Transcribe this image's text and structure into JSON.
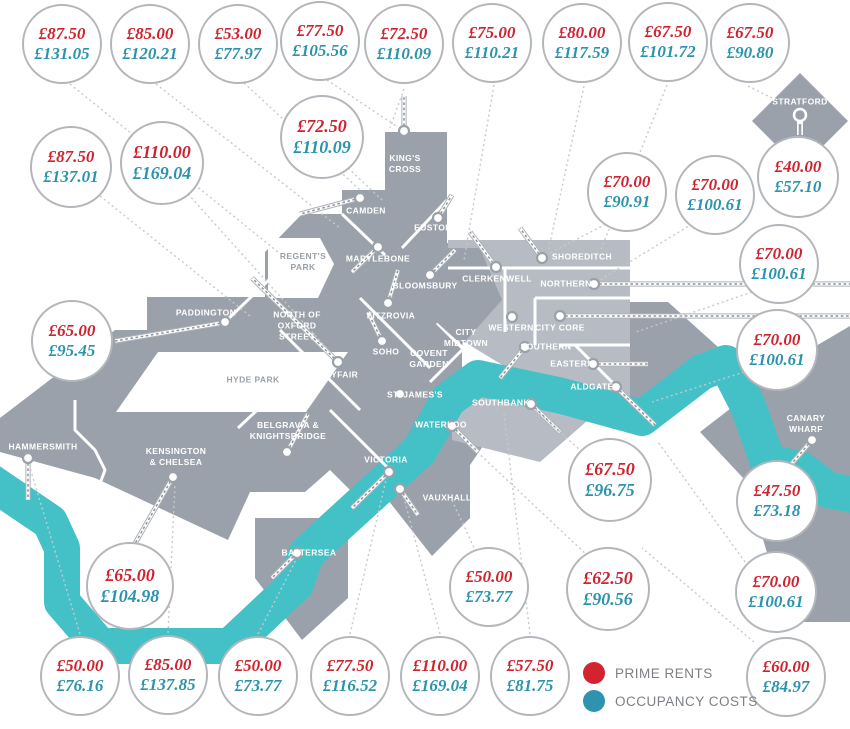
{
  "colors": {
    "rent": "#cf2430",
    "cost": "#2b93ad",
    "river": "#44c1c7",
    "land": "#9ba1aa",
    "land_light": "#b7bcc4"
  },
  "legend": {
    "items": [
      {
        "label": "PRIME RENTS",
        "color": "#d2232f"
      },
      {
        "label": "OCCUPANCY COSTS",
        "color": "#2e93ae"
      }
    ]
  },
  "bubbles": [
    {
      "rent": "£87.50",
      "cost": "£131.05",
      "x": 62,
      "y": 44,
      "r": 40
    },
    {
      "rent": "£85.00",
      "cost": "£120.21",
      "x": 150,
      "y": 44,
      "r": 40
    },
    {
      "rent": "£53.00",
      "cost": "£77.97",
      "x": 238,
      "y": 44,
      "r": 40
    },
    {
      "rent": "£77.50",
      "cost": "£105.56",
      "x": 320,
      "y": 41,
      "r": 40
    },
    {
      "rent": "£72.50",
      "cost": "£110.09",
      "x": 404,
      "y": 44,
      "r": 40
    },
    {
      "rent": "£75.00",
      "cost": "£110.21",
      "x": 492,
      "y": 43,
      "r": 40
    },
    {
      "rent": "£80.00",
      "cost": "£117.59",
      "x": 582,
      "y": 43,
      "r": 40
    },
    {
      "rent": "£67.50",
      "cost": "£101.72",
      "x": 668,
      "y": 42,
      "r": 40
    },
    {
      "rent": "£67.50",
      "cost": "£90.80",
      "x": 750,
      "y": 43,
      "r": 40
    },
    {
      "rent": "£87.50",
      "cost": "£137.01",
      "x": 71,
      "y": 167,
      "r": 41
    },
    {
      "rent": "£110.00",
      "cost": "£169.04",
      "x": 162,
      "y": 163,
      "r": 42
    },
    {
      "rent": "£72.50",
      "cost": "£110.09",
      "x": 322,
      "y": 137,
      "r": 42
    },
    {
      "rent": "£40.00",
      "cost": "£57.10",
      "x": 798,
      "y": 177,
      "r": 41
    },
    {
      "rent": "£70.00",
      "cost": "£90.91",
      "x": 627,
      "y": 192,
      "r": 40
    },
    {
      "rent": "£70.00",
      "cost": "£100.61",
      "x": 715,
      "y": 195,
      "r": 40
    },
    {
      "rent": "£70.00",
      "cost": "£100.61",
      "x": 779,
      "y": 264,
      "r": 40
    },
    {
      "rent": "£65.00",
      "cost": "£95.45",
      "x": 72,
      "y": 341,
      "r": 41
    },
    {
      "rent": "£70.00",
      "cost": "£100.61",
      "x": 777,
      "y": 350,
      "r": 41
    },
    {
      "rent": "£47.50",
      "cost": "£73.18",
      "x": 777,
      "y": 501,
      "r": 41
    },
    {
      "rent": "£67.50",
      "cost": "£96.75",
      "x": 610,
      "y": 480,
      "r": 42
    },
    {
      "rent": "£62.50",
      "cost": "£90.56",
      "x": 608,
      "y": 589,
      "r": 42
    },
    {
      "rent": "£50.00",
      "cost": "£73.77",
      "x": 489,
      "y": 587,
      "r": 40
    },
    {
      "rent": "£65.00",
      "cost": "£104.98",
      "x": 130,
      "y": 586,
      "r": 44
    },
    {
      "rent": "£70.00",
      "cost": "£100.61",
      "x": 776,
      "y": 592,
      "r": 41
    },
    {
      "rent": "£50.00",
      "cost": "£76.16",
      "x": 80,
      "y": 676,
      "r": 40
    },
    {
      "rent": "£85.00",
      "cost": "£137.85",
      "x": 168,
      "y": 675,
      "r": 40
    },
    {
      "rent": "£50.00",
      "cost": "£73.77",
      "x": 258,
      "y": 676,
      "r": 40
    },
    {
      "rent": "£77.50",
      "cost": "£116.52",
      "x": 350,
      "y": 676,
      "r": 40
    },
    {
      "rent": "£110.00",
      "cost": "£169.04",
      "x": 440,
      "y": 676,
      "r": 40
    },
    {
      "rent": "£57.50",
      "cost": "£81.75",
      "x": 530,
      "y": 676,
      "r": 40
    },
    {
      "rent": "£60.00",
      "cost": "£84.97",
      "x": 786,
      "y": 677,
      "r": 40
    }
  ],
  "areas": [
    {
      "label": "STRATFORD",
      "x": 800,
      "y": 102,
      "tone": "on-land"
    },
    {
      "label": "KING'S\nCROSS",
      "x": 405,
      "y": 164,
      "tone": "on-land"
    },
    {
      "label": "CAMDEN",
      "x": 366,
      "y": 211,
      "tone": "on-land"
    },
    {
      "label": "EUSTON",
      "x": 433,
      "y": 228,
      "tone": "on-land"
    },
    {
      "label": "REGENT'S\nPARK",
      "x": 303,
      "y": 262,
      "tone": "park"
    },
    {
      "label": "MARYLEBONE",
      "x": 378,
      "y": 259,
      "tone": "on-land"
    },
    {
      "label": "BLOOMSBURY",
      "x": 425,
      "y": 286,
      "tone": "on-land"
    },
    {
      "label": "CLERKENWELL",
      "x": 497,
      "y": 279,
      "tone": "on-land"
    },
    {
      "label": "SHOREDITCH",
      "x": 582,
      "y": 257,
      "tone": "on-land"
    },
    {
      "label": "NORTHERN",
      "x": 566,
      "y": 284,
      "tone": "on-land"
    },
    {
      "label": "PADDINGTON",
      "x": 206,
      "y": 313,
      "tone": "on-land"
    },
    {
      "label": "NORTH OF\nOXFORD\nSTREET",
      "x": 297,
      "y": 326,
      "tone": "on-land"
    },
    {
      "label": "FITZROVIA",
      "x": 391,
      "y": 316,
      "tone": "on-land"
    },
    {
      "label": "WESTERN",
      "x": 511,
      "y": 328,
      "tone": "on-land"
    },
    {
      "label": "CITY CORE",
      "x": 560,
      "y": 328,
      "tone": "on-land"
    },
    {
      "label": "CITY\nMIDTOWN",
      "x": 466,
      "y": 338,
      "tone": "on-land"
    },
    {
      "label": "SOHO",
      "x": 386,
      "y": 352,
      "tone": "on-land"
    },
    {
      "label": "COVENT\nGARDEN",
      "x": 429,
      "y": 359,
      "tone": "on-land"
    },
    {
      "label": "SOUTHERN",
      "x": 546,
      "y": 347,
      "tone": "on-land"
    },
    {
      "label": "MAYFAIR",
      "x": 338,
      "y": 375,
      "tone": "on-land"
    },
    {
      "label": "HYDE PARK",
      "x": 253,
      "y": 380,
      "tone": "park"
    },
    {
      "label": "EASTERN",
      "x": 572,
      "y": 364,
      "tone": "on-land"
    },
    {
      "label": "ST. JAMES'S",
      "x": 415,
      "y": 395,
      "tone": "on-land"
    },
    {
      "label": "ALDGATE",
      "x": 592,
      "y": 387,
      "tone": "on-land"
    },
    {
      "label": "SOUTHBANK",
      "x": 501,
      "y": 403,
      "tone": "on-land"
    },
    {
      "label": "CANARY\nWHARF",
      "x": 806,
      "y": 424,
      "tone": "on-land"
    },
    {
      "label": "BELGRAVIA &\nKNIGHTSBRIDGE",
      "x": 288,
      "y": 431,
      "tone": "on-land"
    },
    {
      "label": "WATERLOO",
      "x": 441,
      "y": 425,
      "tone": "on-land"
    },
    {
      "label": "HAMMERSMITH",
      "x": 43,
      "y": 447,
      "tone": "on-land"
    },
    {
      "label": "KENSINGTON\n& CHELSEA",
      "x": 176,
      "y": 457,
      "tone": "on-land"
    },
    {
      "label": "VICTORIA",
      "x": 386,
      "y": 460,
      "tone": "on-land"
    },
    {
      "label": "VAUXHALL",
      "x": 447,
      "y": 498,
      "tone": "on-land"
    },
    {
      "label": "BATTERSEA",
      "x": 309,
      "y": 553,
      "tone": "on-land"
    }
  ]
}
